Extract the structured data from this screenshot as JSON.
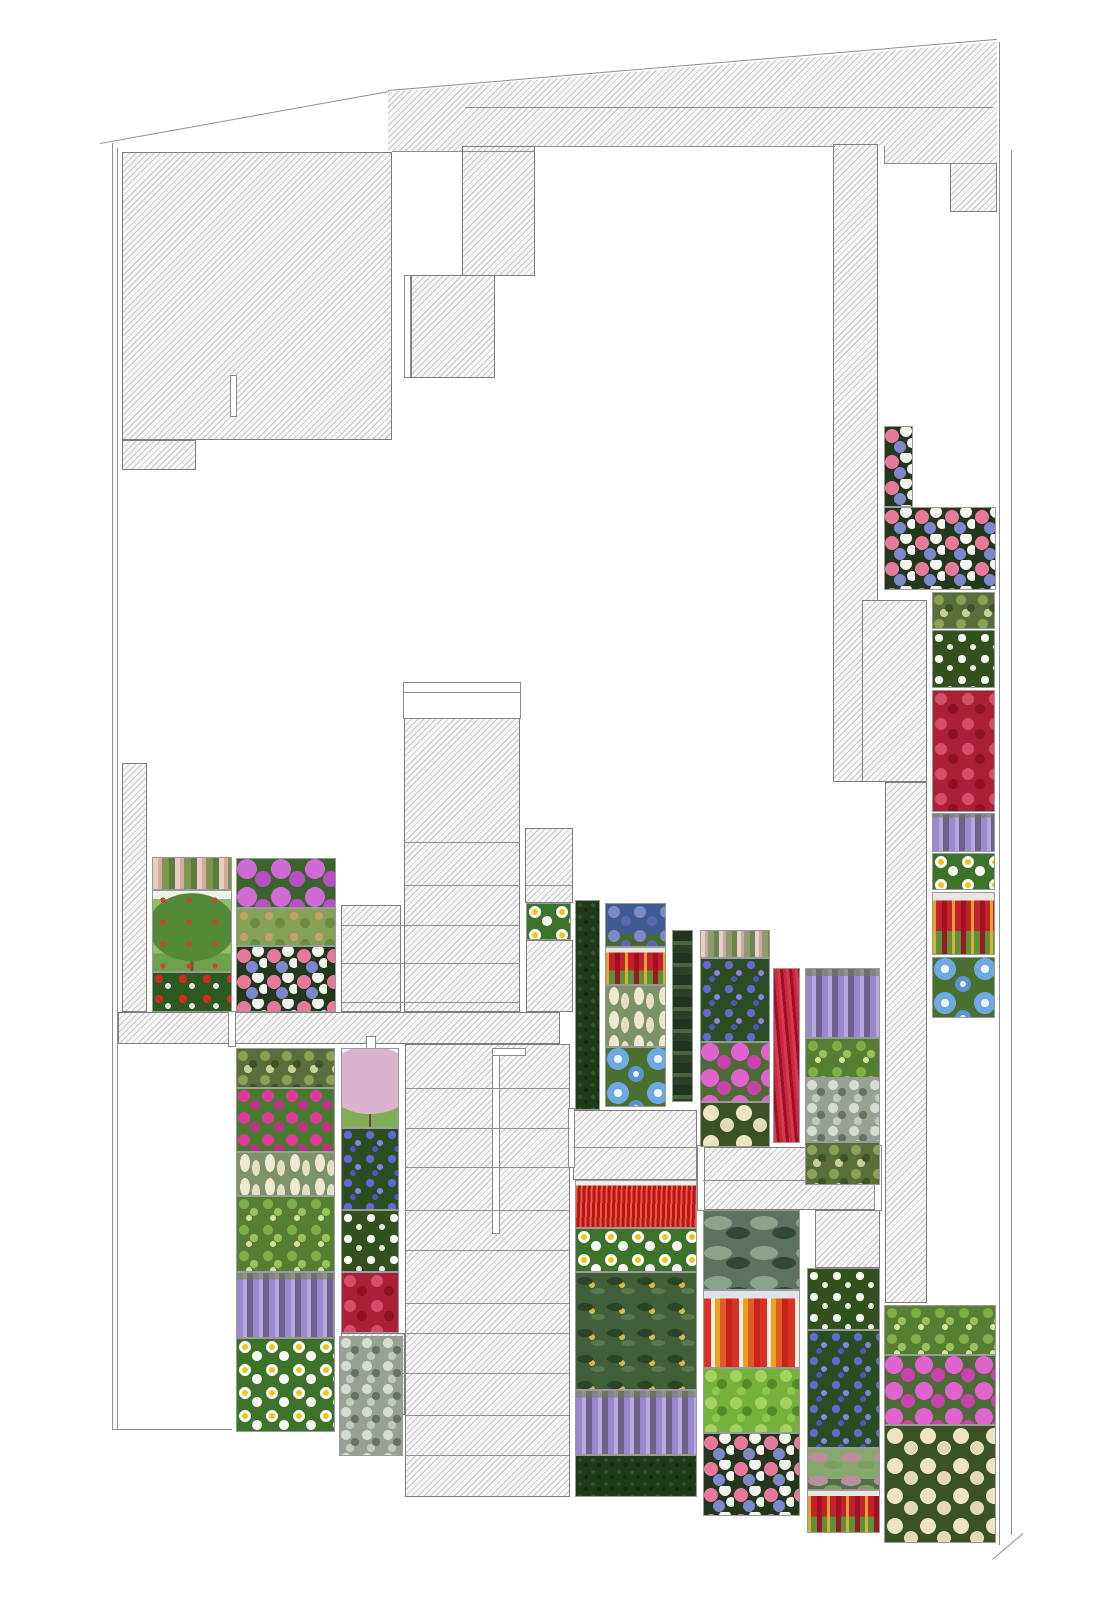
{
  "page": {
    "kind": "architectural planting plan drawing",
    "visible_text": "none"
  },
  "palette": {
    "background": "#ffffff",
    "hatch_line": "#c6c6c6",
    "hatch_fill": "#f7f7f7",
    "shape_outline": "#7d7d7d",
    "boundary_line": "#8f8f8f",
    "wisteria_lavender": "#a795d6",
    "phlox_magenta": "#d84fc0",
    "celosia_red": "#c6212f",
    "red_grass": "#d2251a",
    "meconopsis_blue": "#6fa8e8",
    "daisy_white": "#ffffff",
    "foliage_green": "#3f6b2f",
    "dusty_miller_silver": "#b9c2b7",
    "hedge_dark_green": "#24401e"
  },
  "plan": {
    "width": 1120,
    "height": 1600,
    "hatch_shapes": [
      {
        "name": "building-block-northwest",
        "x": 122,
        "y": 152,
        "w": 270,
        "h": 288
      },
      {
        "name": "building-block-northwest-foot",
        "x": 122,
        "y": 440,
        "w": 74,
        "h": 30
      },
      {
        "name": "roof-band-north",
        "x": 388,
        "y": 40,
        "w": 609,
        "h": 123,
        "clip": "0px 52px,609px 2px,609px 123px,496px 123px,496px 106px,147px 106px,147px 112px,0px 112px"
      },
      {
        "name": "stair-core-north",
        "x": 462,
        "y": 146,
        "w": 73,
        "h": 130
      },
      {
        "name": "roof-block-mid-north",
        "x": 411,
        "y": 275,
        "w": 84,
        "h": 103
      },
      {
        "name": "building-block-northeast",
        "x": 950,
        "y": 163,
        "w": 47,
        "h": 49
      },
      {
        "name": "service-band-east-upper",
        "x": 833,
        "y": 144,
        "w": 45,
        "h": 638
      },
      {
        "name": "service-band-east-wide",
        "x": 862,
        "y": 600,
        "w": 65,
        "h": 182
      },
      {
        "name": "service-band-east-lower",
        "x": 885,
        "y": 782,
        "w": 42,
        "h": 521
      },
      {
        "name": "wall-strip-west",
        "x": 122,
        "y": 763,
        "w": 25,
        "h": 249
      },
      {
        "name": "terrace-band-west",
        "x": 118,
        "y": 1012,
        "w": 442,
        "h": 32
      },
      {
        "name": "stair-tower-upper",
        "x": 404,
        "y": 718,
        "w": 116,
        "h": 294
      },
      {
        "name": "terrace-step-left",
        "x": 341,
        "y": 905,
        "w": 60,
        "h": 107
      },
      {
        "name": "terrace-step-right-upper",
        "x": 525,
        "y": 828,
        "w": 48,
        "h": 75
      },
      {
        "name": "terrace-step-right-lower",
        "x": 526,
        "y": 940,
        "w": 47,
        "h": 72
      },
      {
        "name": "stair-tower-lower",
        "x": 405,
        "y": 1044,
        "w": 165,
        "h": 453
      },
      {
        "name": "terrace-step-left-lower",
        "x": 341,
        "y": 1333,
        "w": 64,
        "h": 82
      },
      {
        "name": "terrace-step-mid-east",
        "x": 573,
        "y": 1110,
        "w": 124,
        "h": 70
      },
      {
        "name": "terrace-step-east",
        "x": 703,
        "y": 1147,
        "w": 177,
        "h": 63
      },
      {
        "name": "terrace-step-southeast",
        "x": 815,
        "y": 1210,
        "w": 65,
        "h": 58
      }
    ],
    "white_shapes": [
      {
        "name": "roof-slit-northwest",
        "x": 230,
        "y": 375,
        "w": 7,
        "h": 42
      },
      {
        "name": "stair-slot-north",
        "x": 404,
        "y": 275,
        "w": 7,
        "h": 103
      },
      {
        "name": "stair-tower-cap",
        "x": 403,
        "y": 682,
        "w": 118,
        "h": 37
      },
      {
        "name": "retaining-edge-west",
        "x": 228,
        "y": 1011,
        "w": 8,
        "h": 36
      },
      {
        "name": "retaining-edge-mid",
        "x": 366,
        "y": 1036,
        "w": 10,
        "h": 26
      },
      {
        "name": "path-slot-vertical",
        "x": 492,
        "y": 1048,
        "w": 8,
        "h": 186
      },
      {
        "name": "path-slot-top",
        "x": 492,
        "y": 1048,
        "w": 34,
        "h": 8
      },
      {
        "name": "retaining-edge-hedge",
        "x": 568,
        "y": 1108,
        "w": 7,
        "h": 60
      },
      {
        "name": "retaining-edge-east-a",
        "x": 697,
        "y": 1145,
        "w": 8,
        "h": 66
      },
      {
        "name": "retaining-edge-east-b",
        "x": 874,
        "y": 1145,
        "w": 8,
        "h": 66
      }
    ],
    "lines": [
      {
        "name": "boundary-left-outer",
        "x": 112,
        "y": 143,
        "w": 1,
        "h": 1287
      },
      {
        "name": "boundary-left-inner",
        "x": 117,
        "y": 148,
        "w": 1,
        "h": 1282
      },
      {
        "name": "boundary-top-west",
        "x": 100,
        "y": 143,
        "w": 293,
        "h": 1,
        "rot": -10.2
      },
      {
        "name": "boundary-top-north",
        "x": 388,
        "y": 90,
        "w": 611,
        "h": 1,
        "rot": -4.8
      },
      {
        "name": "boundary-right-outer",
        "x": 999,
        "y": 42,
        "w": 1,
        "h": 1503
      },
      {
        "name": "boundary-right-inner",
        "x": 1011,
        "y": 150,
        "w": 1,
        "h": 1385
      },
      {
        "name": "boundary-bottom-west",
        "x": 113,
        "y": 1429,
        "w": 119,
        "h": 1
      },
      {
        "name": "boundary-bottom-east-diagonal",
        "x": 992,
        "y": 1559,
        "w": 40,
        "h": 1,
        "rot": -40
      },
      {
        "name": "roof-band-inner-line",
        "x": 465,
        "y": 107,
        "w": 528,
        "h": 1
      },
      {
        "name": "roof-band-edge-a",
        "x": 535,
        "y": 146,
        "w": 300,
        "h": 1
      },
      {
        "name": "roof-band-edge-b",
        "x": 884,
        "y": 163,
        "w": 113,
        "h": 1
      },
      {
        "name": "roof-band-edge-c",
        "x": 884,
        "y": 146,
        "w": 1,
        "h": 18
      },
      {
        "name": "block-top-line",
        "x": 392,
        "y": 151,
        "w": 143,
        "h": 1
      },
      {
        "name": "stair-tower-cap-line",
        "x": 404,
        "y": 692,
        "w": 117,
        "h": 1
      },
      {
        "name": "stair-line",
        "x": 404,
        "y": 842,
        "w": 116,
        "h": 1
      },
      {
        "name": "stair-line",
        "x": 404,
        "y": 885,
        "w": 116,
        "h": 1
      },
      {
        "name": "stair-line",
        "x": 404,
        "y": 925,
        "w": 116,
        "h": 1
      },
      {
        "name": "stair-line",
        "x": 404,
        "y": 963,
        "w": 116,
        "h": 1
      },
      {
        "name": "stair-line",
        "x": 404,
        "y": 1002,
        "w": 116,
        "h": 1
      },
      {
        "name": "stair-line",
        "x": 341,
        "y": 925,
        "w": 63,
        "h": 1
      },
      {
        "name": "stair-line",
        "x": 341,
        "y": 963,
        "w": 63,
        "h": 1
      },
      {
        "name": "stair-line",
        "x": 341,
        "y": 1002,
        "w": 63,
        "h": 1
      },
      {
        "name": "stair-line",
        "x": 525,
        "y": 885,
        "w": 48,
        "h": 1
      },
      {
        "name": "stair-line",
        "x": 405,
        "y": 1088,
        "w": 165,
        "h": 1
      },
      {
        "name": "stair-line",
        "x": 405,
        "y": 1128,
        "w": 165,
        "h": 1
      },
      {
        "name": "stair-line",
        "x": 405,
        "y": 1167,
        "w": 165,
        "h": 1
      },
      {
        "name": "stair-line",
        "x": 405,
        "y": 1210,
        "w": 165,
        "h": 1
      },
      {
        "name": "stair-line",
        "x": 405,
        "y": 1250,
        "w": 165,
        "h": 1
      },
      {
        "name": "stair-line",
        "x": 405,
        "y": 1303,
        "w": 165,
        "h": 1
      },
      {
        "name": "stair-line",
        "x": 405,
        "y": 1333,
        "w": 165,
        "h": 1
      },
      {
        "name": "stair-line",
        "x": 405,
        "y": 1373,
        "w": 165,
        "h": 1
      },
      {
        "name": "stair-line",
        "x": 405,
        "y": 1415,
        "w": 165,
        "h": 1
      },
      {
        "name": "stair-line",
        "x": 405,
        "y": 1455,
        "w": 165,
        "h": 1
      },
      {
        "name": "stair-line",
        "x": 341,
        "y": 1373,
        "w": 64,
        "h": 1
      },
      {
        "name": "stair-line",
        "x": 703,
        "y": 1180,
        "w": 177,
        "h": 1
      },
      {
        "name": "stair-line",
        "x": 573,
        "y": 1147,
        "w": 124,
        "h": 1
      }
    ],
    "tiles": [
      {
        "name": "horse-chestnut",
        "type": "t-chestnut",
        "x": 152,
        "y": 857,
        "w": 80,
        "h": 33
      },
      {
        "name": "apple-tree",
        "type": "t-apple",
        "x": 152,
        "y": 890,
        "w": 80,
        "h": 82
      },
      {
        "name": "red-impatiens",
        "type": "t-impatiens",
        "x": 152,
        "y": 972,
        "w": 80,
        "h": 40
      },
      {
        "name": "purple-phlox",
        "type": "t-phloxpurple",
        "x": 236,
        "y": 858,
        "w": 100,
        "h": 50
      },
      {
        "name": "cotoneaster",
        "type": "t-cotoneaster",
        "x": 236,
        "y": 908,
        "w": 100,
        "h": 38
      },
      {
        "name": "clematis-mix",
        "type": "t-clematis",
        "x": 236,
        "y": 946,
        "w": 100,
        "h": 66
      },
      {
        "name": "variegated-ivy",
        "type": "t-ivy",
        "x": 236,
        "y": 1048,
        "w": 99,
        "h": 40
      },
      {
        "name": "pink-bellis",
        "type": "t-bellis",
        "x": 236,
        "y": 1088,
        "w": 99,
        "h": 64
      },
      {
        "name": "white-astilbe",
        "type": "t-astilbe",
        "x": 236,
        "y": 1152,
        "w": 99,
        "h": 44
      },
      {
        "name": "green-foliage",
        "type": "t-elder",
        "x": 236,
        "y": 1196,
        "w": 99,
        "h": 76
      },
      {
        "name": "wisteria",
        "type": "t-wisteria",
        "x": 236,
        "y": 1272,
        "w": 99,
        "h": 66
      },
      {
        "name": "marguerite-daisies",
        "type": "t-daisy",
        "x": 236,
        "y": 1338,
        "w": 99,
        "h": 94
      },
      {
        "name": "cherry-tree",
        "type": "t-cherry",
        "x": 341,
        "y": 1048,
        "w": 58,
        "h": 80
      },
      {
        "name": "blue-periwinkle",
        "type": "t-vinca",
        "x": 341,
        "y": 1128,
        "w": 58,
        "h": 82
      },
      {
        "name": "white-gardenia",
        "type": "t-gardenia",
        "x": 341,
        "y": 1210,
        "w": 58,
        "h": 62
      },
      {
        "name": "red-celosia-bush",
        "type": "t-redbush",
        "x": 341,
        "y": 1272,
        "w": 58,
        "h": 61
      },
      {
        "name": "dusty-miller",
        "type": "t-dusty",
        "x": 339,
        "y": 1336,
        "w": 64,
        "h": 120
      },
      {
        "name": "marguerite-daisies",
        "type": "t-daisy",
        "x": 526,
        "y": 903,
        "w": 45,
        "h": 37
      },
      {
        "name": "boxwood-hedge",
        "type": "t-hedge",
        "x": 575,
        "y": 900,
        "w": 25,
        "h": 210
      },
      {
        "name": "blue-campanula",
        "type": "t-campanula",
        "x": 605,
        "y": 903,
        "w": 61,
        "h": 44
      },
      {
        "name": "red-celosia",
        "type": "t-celosia",
        "x": 605,
        "y": 947,
        "w": 61,
        "h": 38
      },
      {
        "name": "white-astilbe",
        "type": "t-astilbe",
        "x": 605,
        "y": 985,
        "w": 61,
        "h": 62
      },
      {
        "name": "blue-poppy",
        "type": "t-meconopsis",
        "x": 605,
        "y": 1047,
        "w": 61,
        "h": 60
      },
      {
        "name": "dark-foliage-strip",
        "type": "t-yuccastrip",
        "x": 672,
        "y": 930,
        "w": 21,
        "h": 172
      },
      {
        "name": "hollyhock-spikes",
        "type": "t-hollyhock",
        "x": 700,
        "y": 930,
        "w": 70,
        "h": 28
      },
      {
        "name": "blue-periwinkle",
        "type": "t-vinca",
        "x": 700,
        "y": 958,
        "w": 70,
        "h": 84
      },
      {
        "name": "pink-phlox",
        "type": "t-phloxpink",
        "x": 700,
        "y": 1042,
        "w": 70,
        "h": 60
      },
      {
        "name": "white-globe-amaranth",
        "type": "t-amaranth",
        "x": 700,
        "y": 1102,
        "w": 70,
        "h": 45
      },
      {
        "name": "red-celosia-strip",
        "type": "t-redstrip",
        "x": 773,
        "y": 968,
        "w": 27,
        "h": 175
      },
      {
        "name": "wisteria",
        "type": "t-wisteria",
        "x": 805,
        "y": 968,
        "w": 75,
        "h": 70
      },
      {
        "name": "green-foliage",
        "type": "t-elder",
        "x": 805,
        "y": 1038,
        "w": 75,
        "h": 40
      },
      {
        "name": "dusty-miller",
        "type": "t-dusty",
        "x": 805,
        "y": 1078,
        "w": 75,
        "h": 64
      },
      {
        "name": "variegated-ivy",
        "type": "t-ivy",
        "x": 805,
        "y": 1142,
        "w": 75,
        "h": 43
      },
      {
        "name": "red-fountain-grass",
        "type": "t-redgrass",
        "x": 575,
        "y": 1180,
        "w": 122,
        "h": 48
      },
      {
        "name": "marguerite-daisies",
        "type": "t-daisy",
        "x": 575,
        "y": 1228,
        "w": 122,
        "h": 44
      },
      {
        "name": "loquat-shrub",
        "type": "t-loquat",
        "x": 575,
        "y": 1272,
        "w": 122,
        "h": 118
      },
      {
        "name": "wisteria",
        "type": "t-wisteria",
        "x": 575,
        "y": 1390,
        "w": 122,
        "h": 65
      },
      {
        "name": "boxwood-hedge",
        "type": "t-hedge",
        "x": 575,
        "y": 1455,
        "w": 122,
        "h": 42
      },
      {
        "name": "agave-yucca",
        "type": "t-yuccawide",
        "x": 703,
        "y": 1210,
        "w": 97,
        "h": 80
      },
      {
        "name": "snapdragons",
        "type": "t-snapdragon",
        "x": 703,
        "y": 1290,
        "w": 97,
        "h": 78
      },
      {
        "name": "tree-canopy",
        "type": "t-treefol",
        "x": 703,
        "y": 1368,
        "w": 97,
        "h": 65
      },
      {
        "name": "clematis-mix",
        "type": "t-clematis",
        "x": 703,
        "y": 1433,
        "w": 97,
        "h": 83
      },
      {
        "name": "white-gardenia",
        "type": "t-gardenia",
        "x": 807,
        "y": 1268,
        "w": 73,
        "h": 62
      },
      {
        "name": "blue-periwinkle",
        "type": "t-vinca",
        "x": 807,
        "y": 1330,
        "w": 73,
        "h": 118
      },
      {
        "name": "silk-tree",
        "type": "t-mimosa",
        "x": 807,
        "y": 1448,
        "w": 73,
        "h": 42
      },
      {
        "name": "red-celosia",
        "type": "t-celosia",
        "x": 807,
        "y": 1490,
        "w": 73,
        "h": 43
      },
      {
        "name": "clematis-mix",
        "type": "t-clematis",
        "x": 884,
        "y": 426,
        "w": 29,
        "h": 81
      },
      {
        "name": "clematis-mix",
        "type": "t-clematis",
        "x": 884,
        "y": 507,
        "w": 112,
        "h": 83
      },
      {
        "name": "variegated-ivy",
        "type": "t-ivy",
        "x": 932,
        "y": 592,
        "w": 63,
        "h": 37
      },
      {
        "name": "white-gardenia",
        "type": "t-gardenia",
        "x": 932,
        "y": 630,
        "w": 63,
        "h": 58
      },
      {
        "name": "red-celosia-bush",
        "type": "t-redbush",
        "x": 932,
        "y": 690,
        "w": 63,
        "h": 122
      },
      {
        "name": "wisteria",
        "type": "t-wisteria",
        "x": 932,
        "y": 813,
        "w": 63,
        "h": 39
      },
      {
        "name": "marguerite-daisies",
        "type": "t-daisy",
        "x": 932,
        "y": 853,
        "w": 63,
        "h": 37
      },
      {
        "name": "red-celosia",
        "type": "t-celosia",
        "x": 932,
        "y": 892,
        "w": 63,
        "h": 63
      },
      {
        "name": "blue-poppy",
        "type": "t-meconopsis",
        "x": 932,
        "y": 957,
        "w": 63,
        "h": 61
      },
      {
        "name": "green-foliage",
        "type": "t-elder",
        "x": 884,
        "y": 1305,
        "w": 112,
        "h": 50
      },
      {
        "name": "pink-phlox",
        "type": "t-phloxpink",
        "x": 884,
        "y": 1355,
        "w": 112,
        "h": 70
      },
      {
        "name": "white-globe-amaranth",
        "type": "t-amaranth",
        "x": 884,
        "y": 1425,
        "w": 112,
        "h": 118
      }
    ]
  }
}
